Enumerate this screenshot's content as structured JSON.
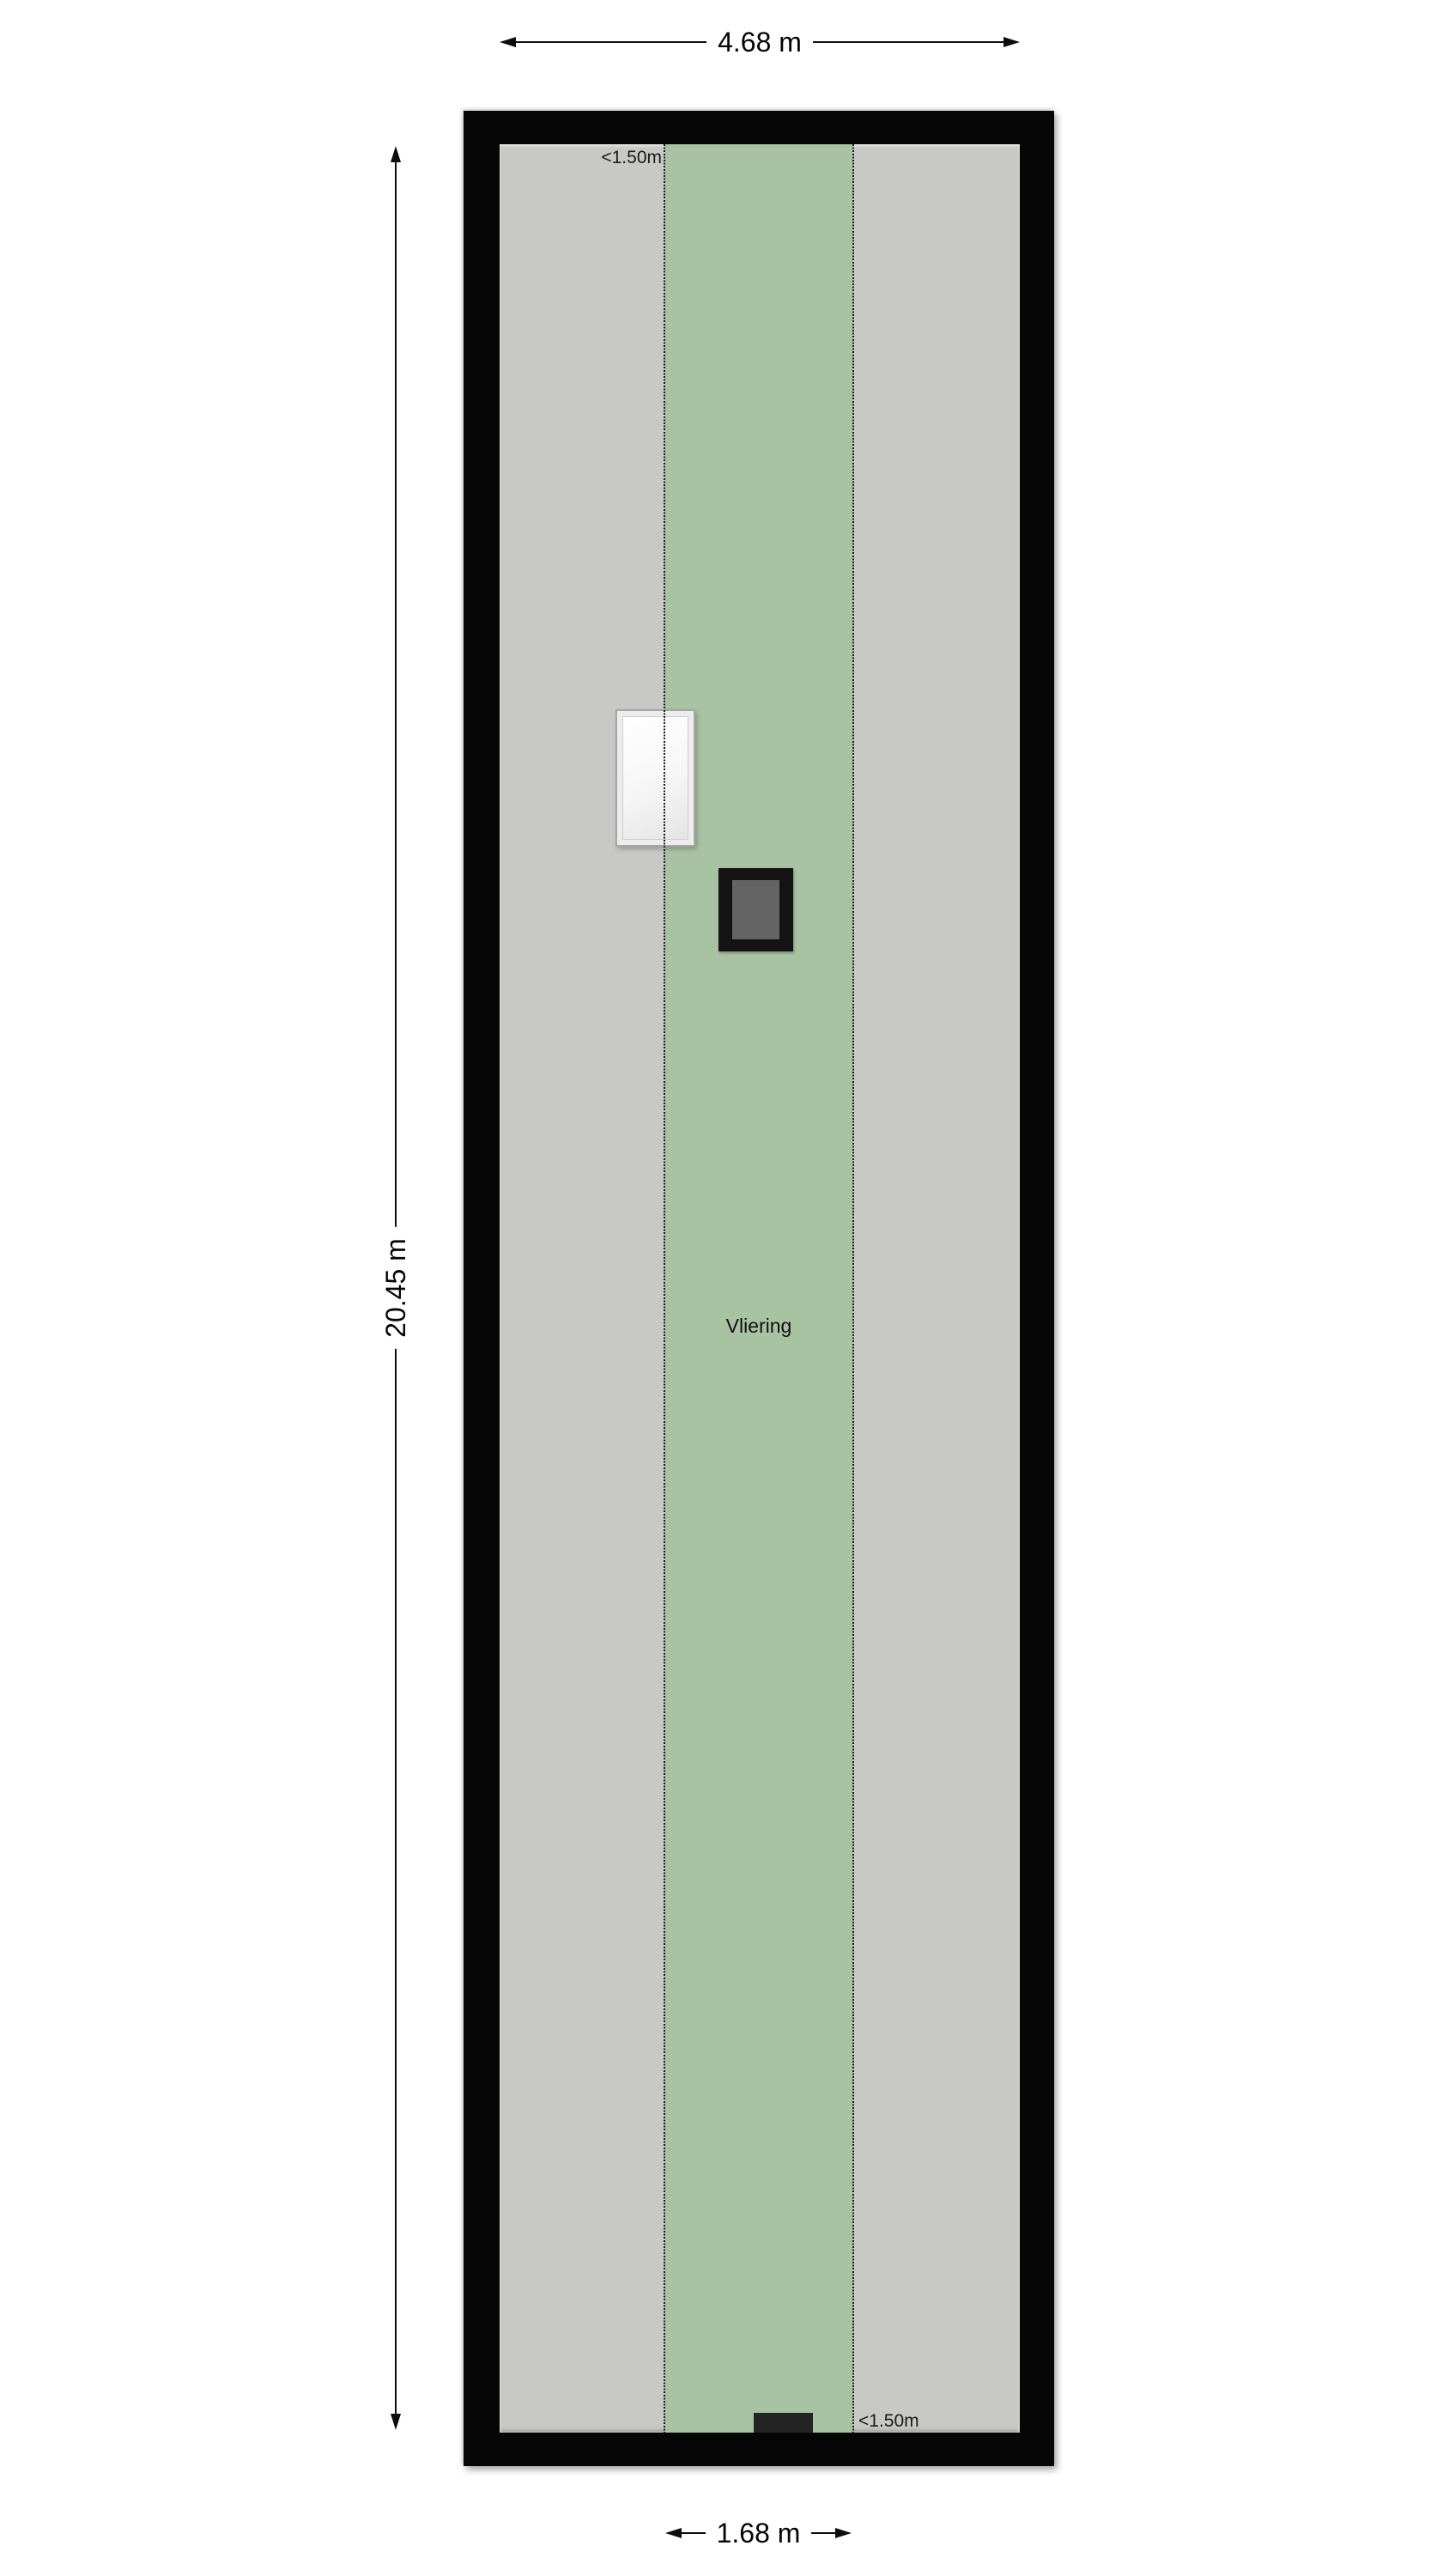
{
  "floorplan": {
    "room": {
      "label": "Vliering"
    },
    "zones": {
      "low_clearance_top_label": "<1.50m",
      "low_clearance_bottom_label": "<1.50m"
    },
    "dimensions": {
      "overall_width": "4.68 m",
      "overall_height": "20.45 m",
      "strip_width": "1.68 m"
    },
    "colors": {
      "wall": "#060606",
      "floor": "#c8c8c7",
      "headroom_zone": "#a8c3a2",
      "dotted_line": "#1c1c1c",
      "window_frame": "#ececec",
      "window_glass": "#f6f6f6",
      "skylight_frame": "#141414",
      "skylight_glass": "#646464",
      "hatch": "#232323",
      "dimension_ink": "#0d0d0d",
      "background": "#ffffff"
    }
  }
}
